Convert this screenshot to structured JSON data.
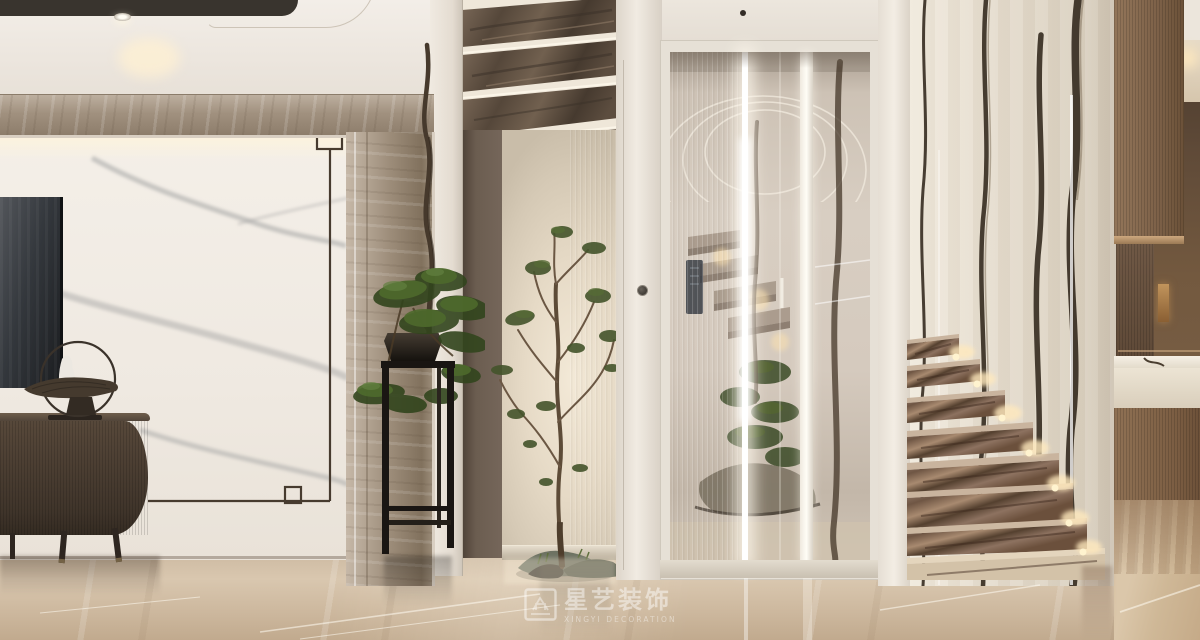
{
  "watermark": {
    "brand": "星艺装饰",
    "brand_en": "XINGYI DECORATION",
    "logo_icon": "square-seal-icon",
    "color": "rgba(255,255,255,0.55)"
  },
  "palette": {
    "ceiling": "#ece6de",
    "ceiling_recess": "#39342e",
    "marble_frame_grey": "#a5968a",
    "feature_wall_white": "#f1ece5",
    "feature_wall_vein": "#9a9b9b",
    "metal_frame_line": "#473b2f",
    "tv_screen": "#3a3e44",
    "tv_cabinet_wood": "#4b3e33",
    "hallway_wall_brown": "#665a4e",
    "alcove_backlight": "#f3e9d7",
    "stair_soffit_marble": "#5f5245",
    "elevator_frame_white": "#e7e1d7",
    "glass_tint": "#cfc5b9",
    "led_strip": "#ffffff",
    "stair_wall_marble": "#e7dfd1",
    "stair_wall_vein": "#2b2116",
    "stair_tread_marble": "#8a7060",
    "tread_uplight": "#ffe9bd",
    "right_wood_panel": "#8a6e54",
    "floor_marble": "#d5c2a9",
    "foliage_green": "#45552c"
  },
  "scene": {
    "type": "photorealistic interior render",
    "areas": [
      "tv-feature-wall",
      "tv-cabinet",
      "bonsai-plant-stand",
      "atrium-tree-alcove",
      "glass-elevator",
      "floating-marble-staircase",
      "kitchen-pass-through"
    ]
  }
}
